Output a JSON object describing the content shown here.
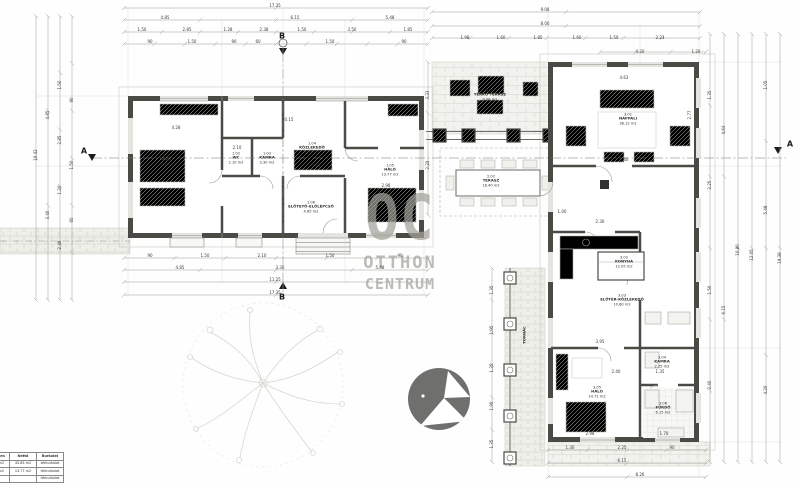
{
  "watermark": {
    "line1": "OC",
    "line2": "OTTHON",
    "line3": "CENTRUM",
    "color": "#a3a29a"
  },
  "section_markers": [
    {
      "label": "A",
      "x": 84,
      "y": 151
    },
    {
      "label": "A",
      "x": 790,
      "y": 144
    },
    {
      "label": "B",
      "x": 282,
      "y": 36
    },
    {
      "label": "B",
      "x": 282,
      "y": 297
    }
  ],
  "room_labels": [
    {
      "code": "1.01",
      "name": "HÁLÓ",
      "area": "17.35 m2",
      "x": 167,
      "y": 160
    },
    {
      "code": "1.02",
      "name": "WC",
      "area": "2.10 m2",
      "x": 236,
      "y": 158
    },
    {
      "code": "1.03",
      "name": "KAMRA",
      "area": "3.30 m2",
      "x": 267,
      "y": 158
    },
    {
      "code": "1.04",
      "name": "KÖZLEKEDŐ",
      "area": "6.15 m2",
      "x": 312,
      "y": 148
    },
    {
      "code": "1.05",
      "name": "HÁLÓ",
      "area": "13.77 m2",
      "x": 390,
      "y": 170
    },
    {
      "code": "1.06",
      "name": "ELŐTETŐ-ELŐLÉPCSŐ",
      "area": "4.85 m2",
      "x": 311,
      "y": 207
    },
    {
      "code": "2.01",
      "name": "TÉRKŐ TERASZ",
      "area": "9.08 m2",
      "x": 490,
      "y": 95
    },
    {
      "code": "2.02",
      "name": "TERASZ",
      "area": "18.40 m2",
      "x": 491,
      "y": 181
    },
    {
      "code": "3.01",
      "name": "NAPPALI",
      "area": "38.12 m2",
      "x": 628,
      "y": 119
    },
    {
      "code": "3.02",
      "name": "KONYHA",
      "area": "12.05 m2",
      "x": 624,
      "y": 262
    },
    {
      "code": "3.03",
      "name": "ELŐTÉR-KÖZLEKEDŐ",
      "area": "10.80 m2",
      "x": 622,
      "y": 300
    },
    {
      "code": "3.04",
      "name": "KAMRA",
      "area": "2.25 m2",
      "x": 662,
      "y": 362
    },
    {
      "code": "3.05",
      "name": "HÁLÓ",
      "area": "14.71 m2",
      "x": 597,
      "y": 392
    },
    {
      "code": "3.06",
      "name": "FÜRDŐ",
      "area": "6.15 m2",
      "x": 663,
      "y": 408
    },
    {
      "code": "",
      "name": "TORNÁC",
      "area": "",
      "x": 525,
      "y": 335,
      "rot": 1
    }
  ],
  "dim_labels": [
    {
      "t": "17.35",
      "x": 275,
      "y": 6
    },
    {
      "t": "4.85",
      "x": 165,
      "y": 18
    },
    {
      "t": "6.15",
      "x": 295,
      "y": 18
    },
    {
      "t": "5.48",
      "x": 390,
      "y": 18
    },
    {
      "t": "1.50",
      "x": 142,
      "y": 30
    },
    {
      "t": "2.85",
      "x": 187,
      "y": 30
    },
    {
      "t": "1.28",
      "x": 228,
      "y": 30
    },
    {
      "t": "2.38",
      "x": 264,
      "y": 30
    },
    {
      "t": "1.50",
      "x": 302,
      "y": 30
    },
    {
      "t": "3.50",
      "x": 352,
      "y": 30
    },
    {
      "t": "1.85",
      "x": 408,
      "y": 30
    },
    {
      "t": "90",
      "x": 150,
      "y": 42
    },
    {
      "t": "1.50",
      "x": 192,
      "y": 42
    },
    {
      "t": "90",
      "x": 234,
      "y": 42
    },
    {
      "t": "60",
      "x": 258,
      "y": 42
    },
    {
      "t": "1.50",
      "x": 330,
      "y": 42
    },
    {
      "t": "90",
      "x": 404,
      "y": 42
    },
    {
      "t": "9.08",
      "x": 545,
      "y": 10
    },
    {
      "t": "8.00",
      "x": 545,
      "y": 24
    },
    {
      "t": "1.98",
      "x": 465,
      "y": 38
    },
    {
      "t": "1.60",
      "x": 501,
      "y": 38
    },
    {
      "t": "1.85",
      "x": 538,
      "y": 38
    },
    {
      "t": "1.60",
      "x": 577,
      "y": 38
    },
    {
      "t": "1.50",
      "x": 614,
      "y": 38
    },
    {
      "t": "2.23",
      "x": 660,
      "y": 38
    },
    {
      "t": "4.20",
      "x": 640,
      "y": 52
    },
    {
      "t": "1.20",
      "x": 696,
      "y": 52
    },
    {
      "t": "10.42",
      "x": 36,
      "y": 155,
      "r": 1
    },
    {
      "t": "4.85",
      "x": 48,
      "y": 115,
      "r": 1
    },
    {
      "t": "3.40",
      "x": 48,
      "y": 215,
      "r": 1
    },
    {
      "t": "1.50",
      "x": 60,
      "y": 85,
      "r": 1
    },
    {
      "t": "2.85",
      "x": 60,
      "y": 140,
      "r": 1
    },
    {
      "t": "1.20",
      "x": 60,
      "y": 190,
      "r": 1
    },
    {
      "t": "2.40",
      "x": 60,
      "y": 245,
      "r": 1
    },
    {
      "t": "90",
      "x": 72,
      "y": 100,
      "r": 1
    },
    {
      "t": "1.50",
      "x": 72,
      "y": 165,
      "r": 1
    },
    {
      "t": "60",
      "x": 72,
      "y": 220,
      "r": 1
    },
    {
      "t": "1.35",
      "x": 710,
      "y": 95,
      "r": 1
    },
    {
      "t": "2.25",
      "x": 710,
      "y": 185,
      "r": 1
    },
    {
      "t": "1.50",
      "x": 710,
      "y": 290,
      "r": 1
    },
    {
      "t": "2.40",
      "x": 710,
      "y": 385,
      "r": 1
    },
    {
      "t": "4.64",
      "x": 724,
      "y": 130,
      "r": 1
    },
    {
      "t": "6.15",
      "x": 724,
      "y": 310,
      "r": 1
    },
    {
      "t": "10.80",
      "x": 738,
      "y": 250,
      "r": 1
    },
    {
      "t": "12.05",
      "x": 752,
      "y": 255,
      "r": 1
    },
    {
      "t": "1.05",
      "x": 766,
      "y": 85,
      "r": 1
    },
    {
      "t": "5.48",
      "x": 766,
      "y": 210,
      "r": 1
    },
    {
      "t": "4.20",
      "x": 766,
      "y": 390,
      "r": 1
    },
    {
      "t": "19.38",
      "x": 780,
      "y": 258,
      "r": 1
    },
    {
      "t": "90",
      "x": 150,
      "y": 256
    },
    {
      "t": "1.50",
      "x": 205,
      "y": 256
    },
    {
      "t": "2.10",
      "x": 262,
      "y": 256
    },
    {
      "t": "1.50",
      "x": 330,
      "y": 256
    },
    {
      "t": "90",
      "x": 400,
      "y": 256
    },
    {
      "t": "4.85",
      "x": 180,
      "y": 268
    },
    {
      "t": "3.30",
      "x": 280,
      "y": 268
    },
    {
      "t": "5.48",
      "x": 380,
      "y": 268
    },
    {
      "t": "11.25",
      "x": 275,
      "y": 280
    },
    {
      "t": "17.35",
      "x": 275,
      "y": 293
    },
    {
      "t": "1.30",
      "x": 570,
      "y": 448
    },
    {
      "t": "2.25",
      "x": 622,
      "y": 448
    },
    {
      "t": "90",
      "x": 672,
      "y": 448
    },
    {
      "t": "6.15",
      "x": 622,
      "y": 461
    },
    {
      "t": "8.26",
      "x": 640,
      "y": 475
    },
    {
      "t": "3.33",
      "x": 428,
      "y": 95,
      "r": 1
    },
    {
      "t": "2.23",
      "x": 428,
      "y": 165,
      "r": 1
    },
    {
      "t": "1.35",
      "x": 492,
      "y": 290,
      "r": 1
    },
    {
      "t": "1.95",
      "x": 492,
      "y": 330,
      "r": 1
    },
    {
      "t": "1.35",
      "x": 492,
      "y": 368,
      "r": 1
    },
    {
      "t": "1.95",
      "x": 492,
      "y": 406,
      "r": 1
    },
    {
      "t": "1.35",
      "x": 492,
      "y": 444,
      "r": 1
    },
    {
      "t": "4.28",
      "x": 176,
      "y": 128
    },
    {
      "t": "2.10",
      "x": 237,
      "y": 148
    },
    {
      "t": "0.15",
      "x": 289,
      "y": 120
    },
    {
      "t": "3.62",
      "x": 316,
      "y": 166
    },
    {
      "t": "2.98",
      "x": 386,
      "y": 186
    },
    {
      "t": "4.63",
      "x": 624,
      "y": 78
    },
    {
      "t": "2.77",
      "x": 690,
      "y": 115,
      "r": 1
    },
    {
      "t": "4.40",
      "x": 624,
      "y": 160
    },
    {
      "t": "1.00",
      "x": 562,
      "y": 212
    },
    {
      "t": "2.30",
      "x": 600,
      "y": 222
    },
    {
      "t": "3.95",
      "x": 600,
      "y": 342
    },
    {
      "t": "2.40",
      "x": 616,
      "y": 372
    },
    {
      "t": "1.35",
      "x": 660,
      "y": 372
    },
    {
      "t": "2.98",
      "x": 590,
      "y": 434
    },
    {
      "t": "1.70",
      "x": 664,
      "y": 434
    }
  ],
  "area_table": {
    "headers": [
      "Összesen",
      "Nettó",
      "Burkolat"
    ],
    "rows": [
      [
        "45.85 m2",
        "45.85 m2",
        "térburkolat"
      ],
      [
        "13.77 m2",
        "13.77 m2",
        "térburkolat"
      ],
      [
        "",
        "",
        "térburkolat"
      ]
    ]
  }
}
